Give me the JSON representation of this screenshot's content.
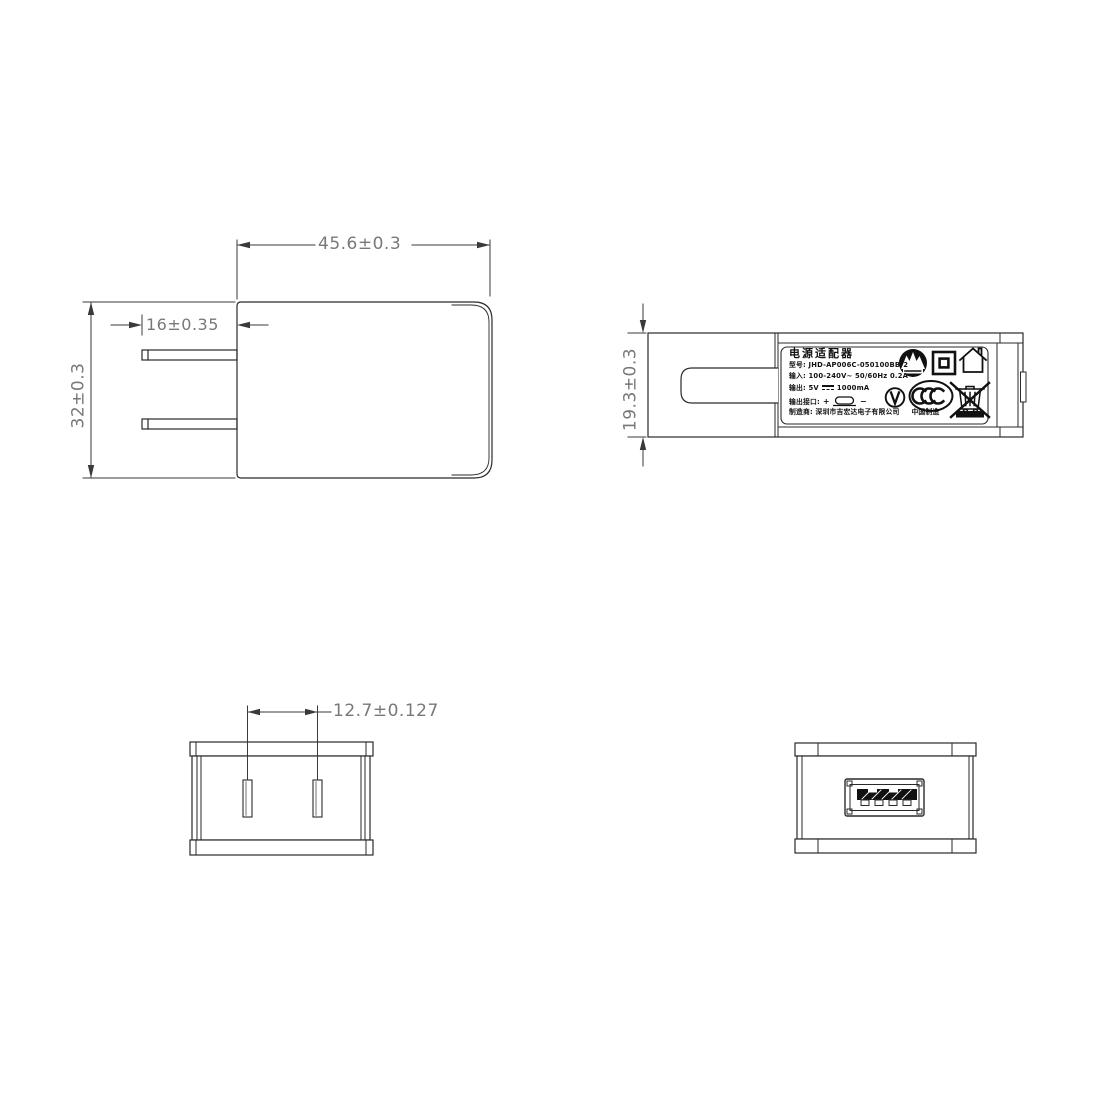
{
  "dims": {
    "front_width": "45.6±0.3",
    "prong_length": "16±0.35",
    "front_height": "32±0.3",
    "side_thickness": "19.3±0.3",
    "pin_pitch": "12.7±0.127"
  },
  "label": {
    "title": "电源适配器",
    "model_line": "型号: JHD-AP006C-050100BB-2",
    "input_line": "输入: 100-240V~  50/60Hz  0.2A",
    "output_prefix": "输出: 5V",
    "output_suffix": "1000mA",
    "port_prefix": "输出接口:",
    "plus": "+",
    "minus": "−",
    "maker_line": "制造商: 深圳市吉宏达电子有限公司",
    "made_in": "中国制造"
  },
  "colors": {
    "line": "#2a2a2a",
    "dim_line": "#3a3a3a",
    "dim_text": "#787878",
    "label_text": "#111111"
  },
  "icons": [
    "cert-circle-icon",
    "double-insulation-icon",
    "indoor-use-icon",
    "efficiency-v-icon",
    "ccc-mark-icon",
    "weee-bin-icon",
    "black-bar-mark"
  ]
}
